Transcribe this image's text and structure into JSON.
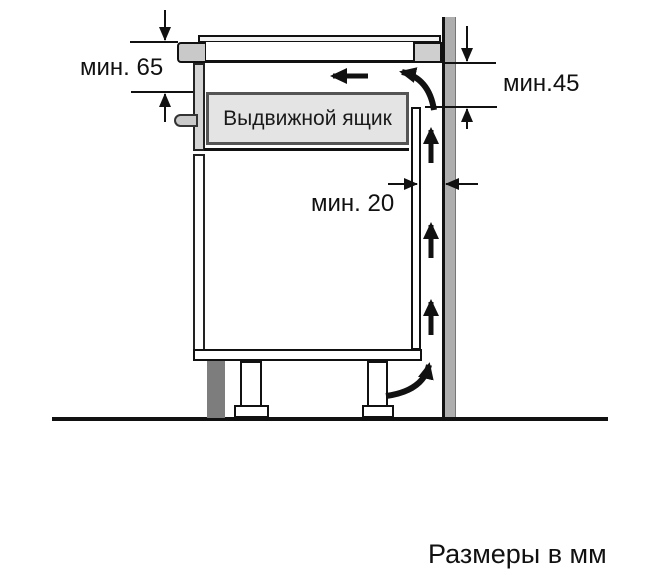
{
  "diagram": {
    "caption": "Размеры в мм",
    "drawer_label": "Выдвижной ящик",
    "dimensions": {
      "hob_to_drawer": "мин. 65",
      "worktop_to_cabinet_rear": "мин.45",
      "rear_wall_gap": "мин. 20"
    },
    "colors": {
      "outline": "#111111",
      "wall_gray": "#aeaeae",
      "plinth_gray": "#7d7d7d",
      "drawer_fill": "#e4e4e4",
      "worktop_section_gray": "#c9c9c9",
      "background": "#ffffff"
    }
  }
}
